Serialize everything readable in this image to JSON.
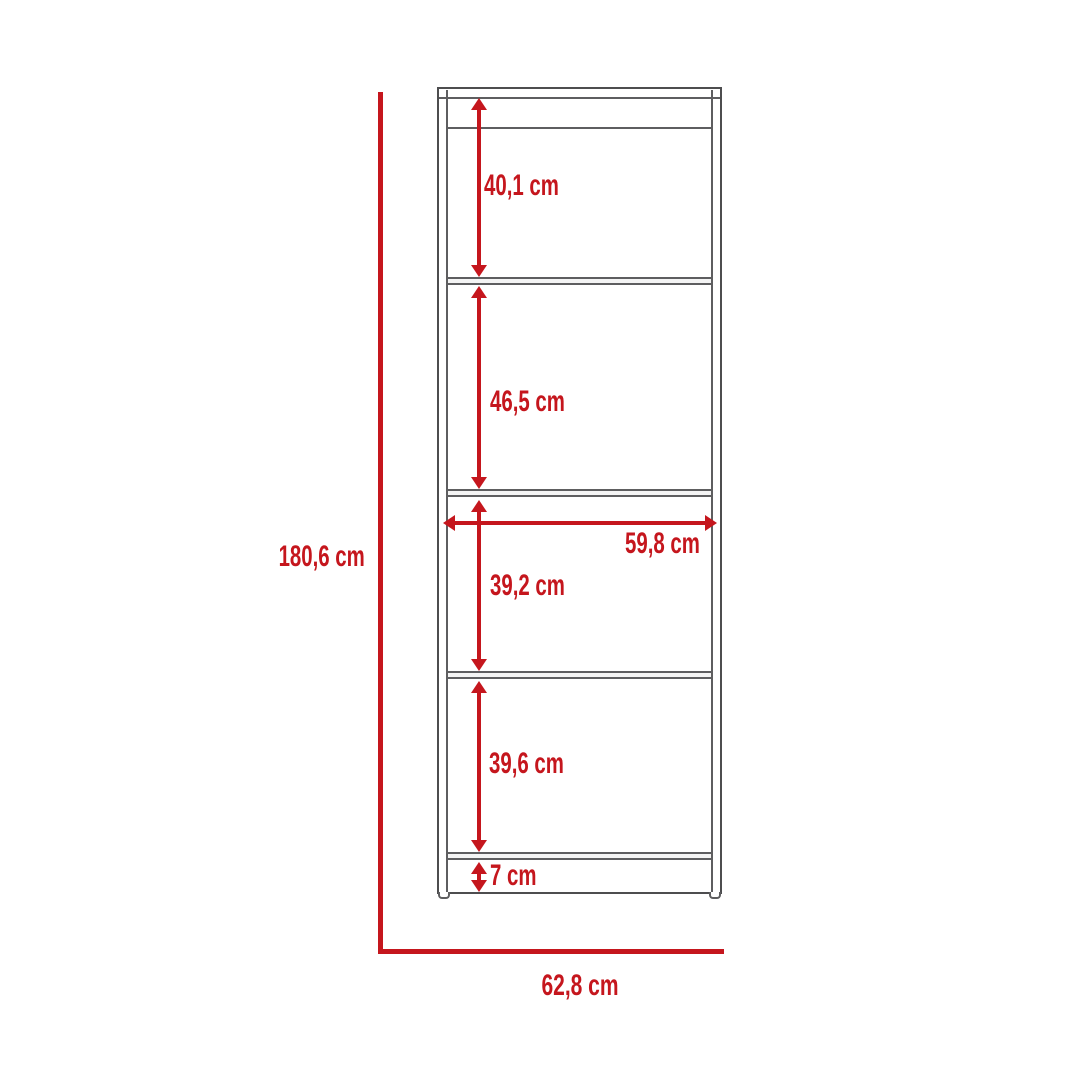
{
  "diagram": {
    "kind": "furniture-dimension-diagram",
    "unit": "cm",
    "colors": {
      "dimension_red": "#c5161d",
      "outline_gray": "#4d4d4f"
    },
    "overall_height": {
      "label": "180,6 cm",
      "value": 180.6
    },
    "overall_width": {
      "label": "62,8 cm",
      "value": 62.8
    },
    "interior_width": {
      "label": "59,8 cm",
      "value": 59.8
    },
    "sections": [
      {
        "name": "top-opening-height",
        "label": "40,1 cm",
        "value": 40.1
      },
      {
        "name": "second-opening-height",
        "label": "46,5 cm",
        "value": 46.5
      },
      {
        "name": "third-opening-height",
        "label": "39,2 cm",
        "value": 39.2
      },
      {
        "name": "fourth-opening-height",
        "label": "39,6 cm",
        "value": 39.6
      },
      {
        "name": "base-plinth-height",
        "label": "7 cm",
        "value": 7
      }
    ]
  }
}
